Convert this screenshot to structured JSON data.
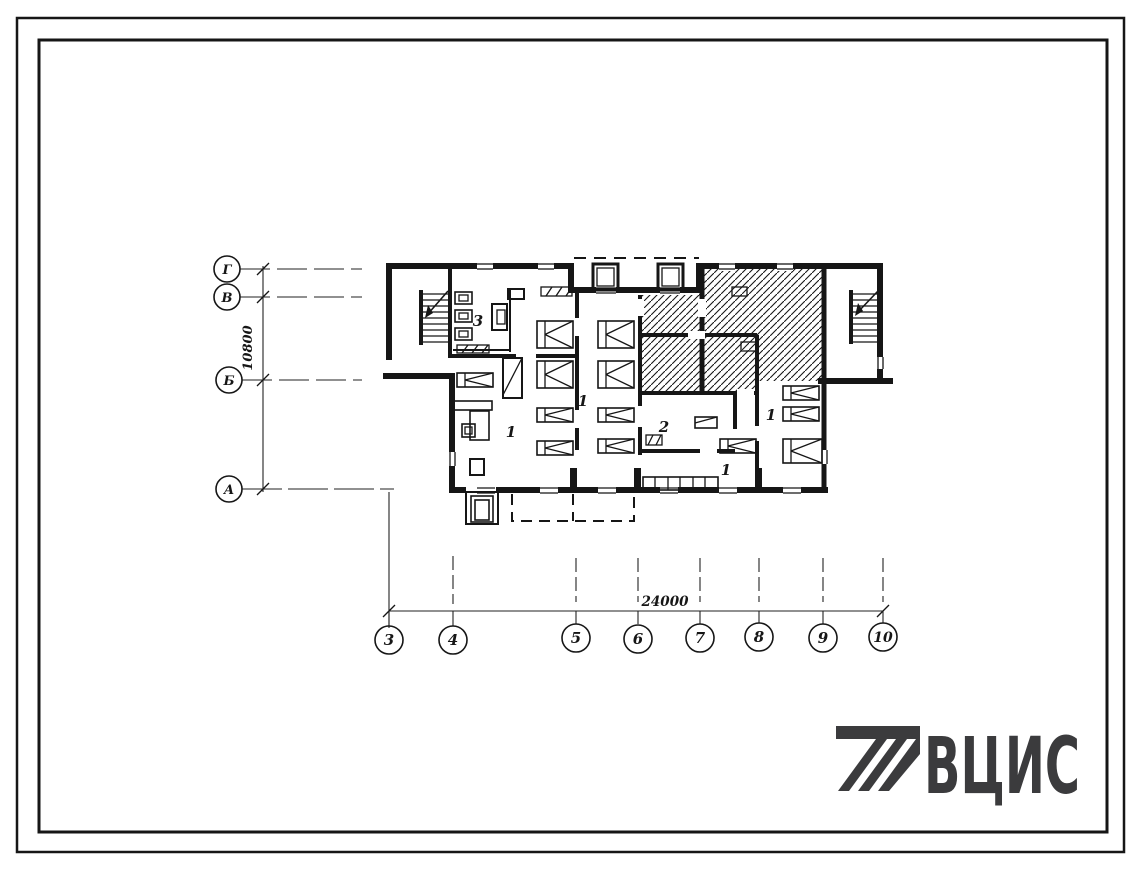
{
  "sheet": {
    "background": "#ffffff",
    "ink": "#161616",
    "logo_color": "#3b3b3d"
  },
  "axes": {
    "rows": [
      {
        "label": "Г"
      },
      {
        "label": "В"
      },
      {
        "label": "Б"
      },
      {
        "label": "А"
      }
    ],
    "columns": [
      {
        "label": "3"
      },
      {
        "label": "4"
      },
      {
        "label": "5"
      },
      {
        "label": "6"
      },
      {
        "label": "7"
      },
      {
        "label": "8"
      },
      {
        "label": "9"
      },
      {
        "label": "10"
      }
    ],
    "height_dimension": "10800",
    "width_dimension": "24000"
  },
  "rooms": [
    {
      "label": "3"
    },
    {
      "label": "1"
    },
    {
      "label": "1"
    },
    {
      "label": "2"
    },
    {
      "label": "1"
    },
    {
      "label": "1"
    }
  ],
  "logo": {
    "text": "ВЦИС"
  }
}
